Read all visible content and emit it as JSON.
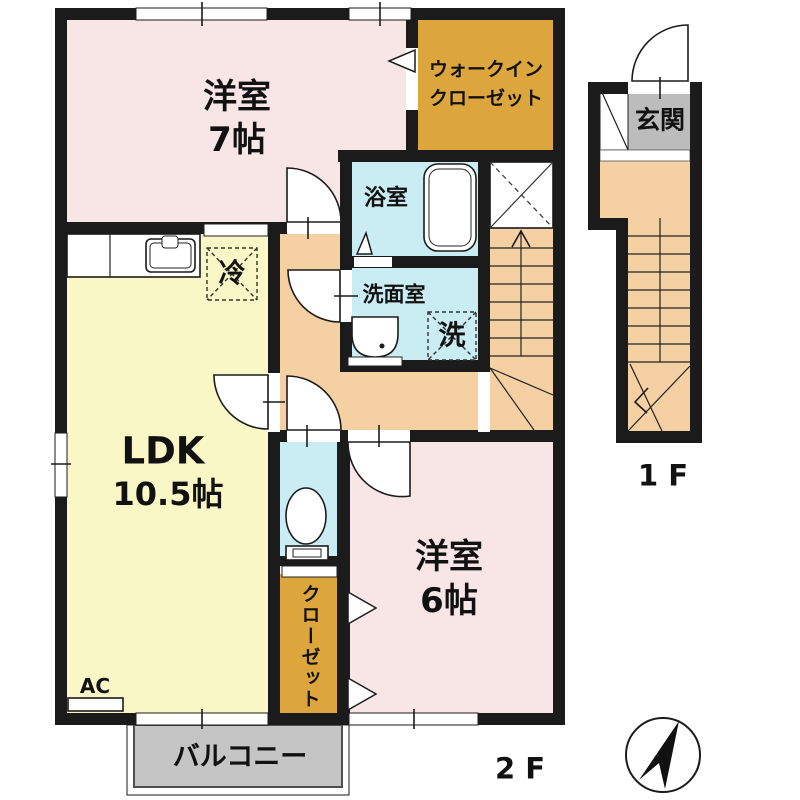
{
  "floor2": {
    "western_room_7": {
      "line1": "洋室",
      "line2": "7帖"
    },
    "walk_in_closet": {
      "line1": "ウォークイン",
      "line2": "クローゼット"
    },
    "bathroom": {
      "label": "浴室"
    },
    "washroom": {
      "label": "洗面室"
    },
    "washer_box": {
      "label": "洗"
    },
    "fridge_box": {
      "label": "冷"
    },
    "ldk": {
      "line1": "LDK",
      "line2": "10.5帖"
    },
    "closet": {
      "label": "クローゼット"
    },
    "western_room_6": {
      "line1": "洋室",
      "line2": "6帖"
    },
    "balcony": {
      "label": "バルコニー"
    },
    "ac": {
      "label": "AC"
    },
    "floor_label": "2 F"
  },
  "floor1": {
    "entrance": {
      "label": "玄関"
    },
    "floor_label": "1 F"
  },
  "colors": {
    "wall": "#1b1b1b",
    "pink": "#f8e6e6",
    "yellow": "#f9f7c5",
    "orange": "#f5d0a3",
    "gold": "#dda63c",
    "blue": "#c9edf2",
    "gray": "#bcbcbc",
    "balcony": "#c5c5c5"
  }
}
